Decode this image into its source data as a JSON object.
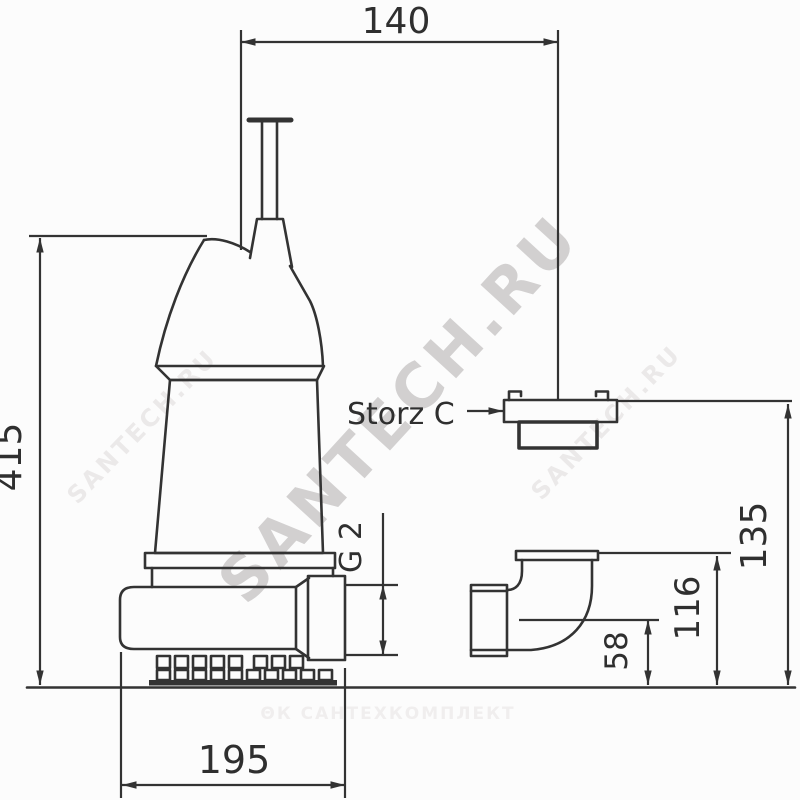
{
  "drawing": {
    "labels": {
      "dim_top_width": "140",
      "dim_total_height": "415",
      "dim_base_width": "195",
      "dim_thread": "G 2",
      "coupling_label": "Storz C",
      "dim_hose_height": "135",
      "dim_outlet_height": "116",
      "dim_center_height": "58"
    },
    "watermarks": {
      "diagonal_main": "SANTECH.RU",
      "diagonal_faint_left": "SANTECH.RU",
      "diagonal_faint_right": "SANTECH.RU",
      "footer": "ΘК САНТЕХКОМПЛЕКТ"
    },
    "colors": {
      "line": "#333333",
      "text": "#2f2f2f",
      "watermark_main": "#d2d0d0",
      "watermark_faint": "#ebe9e9",
      "watermark_footer": "#f0eeee",
      "background": "#fcfcfc"
    }
  }
}
